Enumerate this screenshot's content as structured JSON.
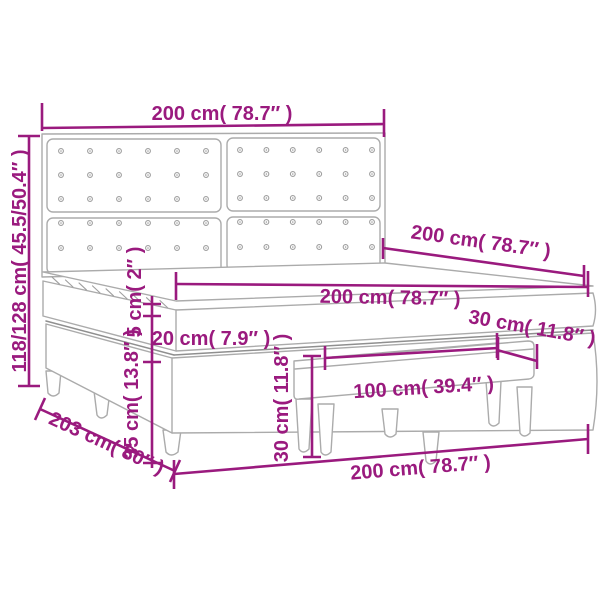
{
  "diagram": {
    "title": "Box spring bed with tufted headboard and bench — dimension drawing",
    "colors": {
      "dimension": "#9A1A7E",
      "artwork": "#ABABAB",
      "artwork_dark": "#8F8F8F",
      "background": "#FFFFFF"
    },
    "labels": {
      "headboard_width": "200 cm( 78.7″ )",
      "headboard_height": "118/128 cm( 45.5/50.4″ )",
      "length_top": "200 cm( 78.7″ )",
      "mattress_width": "200 cm( 78.7″ )",
      "bench_depth": "30 cm( 11.8″ )",
      "mattress_height": "20 cm( 7.9″ )",
      "topper_height": "5 cm( 2″ )",
      "base_height": "35 cm( 13.8″ )",
      "bench_height": "30 cm( 11.8″ )",
      "bench_width": "100 cm( 39.4″ )",
      "length_bottom": "203 cm( 80″ )",
      "width_bottom": "200 cm( 78.7″ )"
    }
  }
}
